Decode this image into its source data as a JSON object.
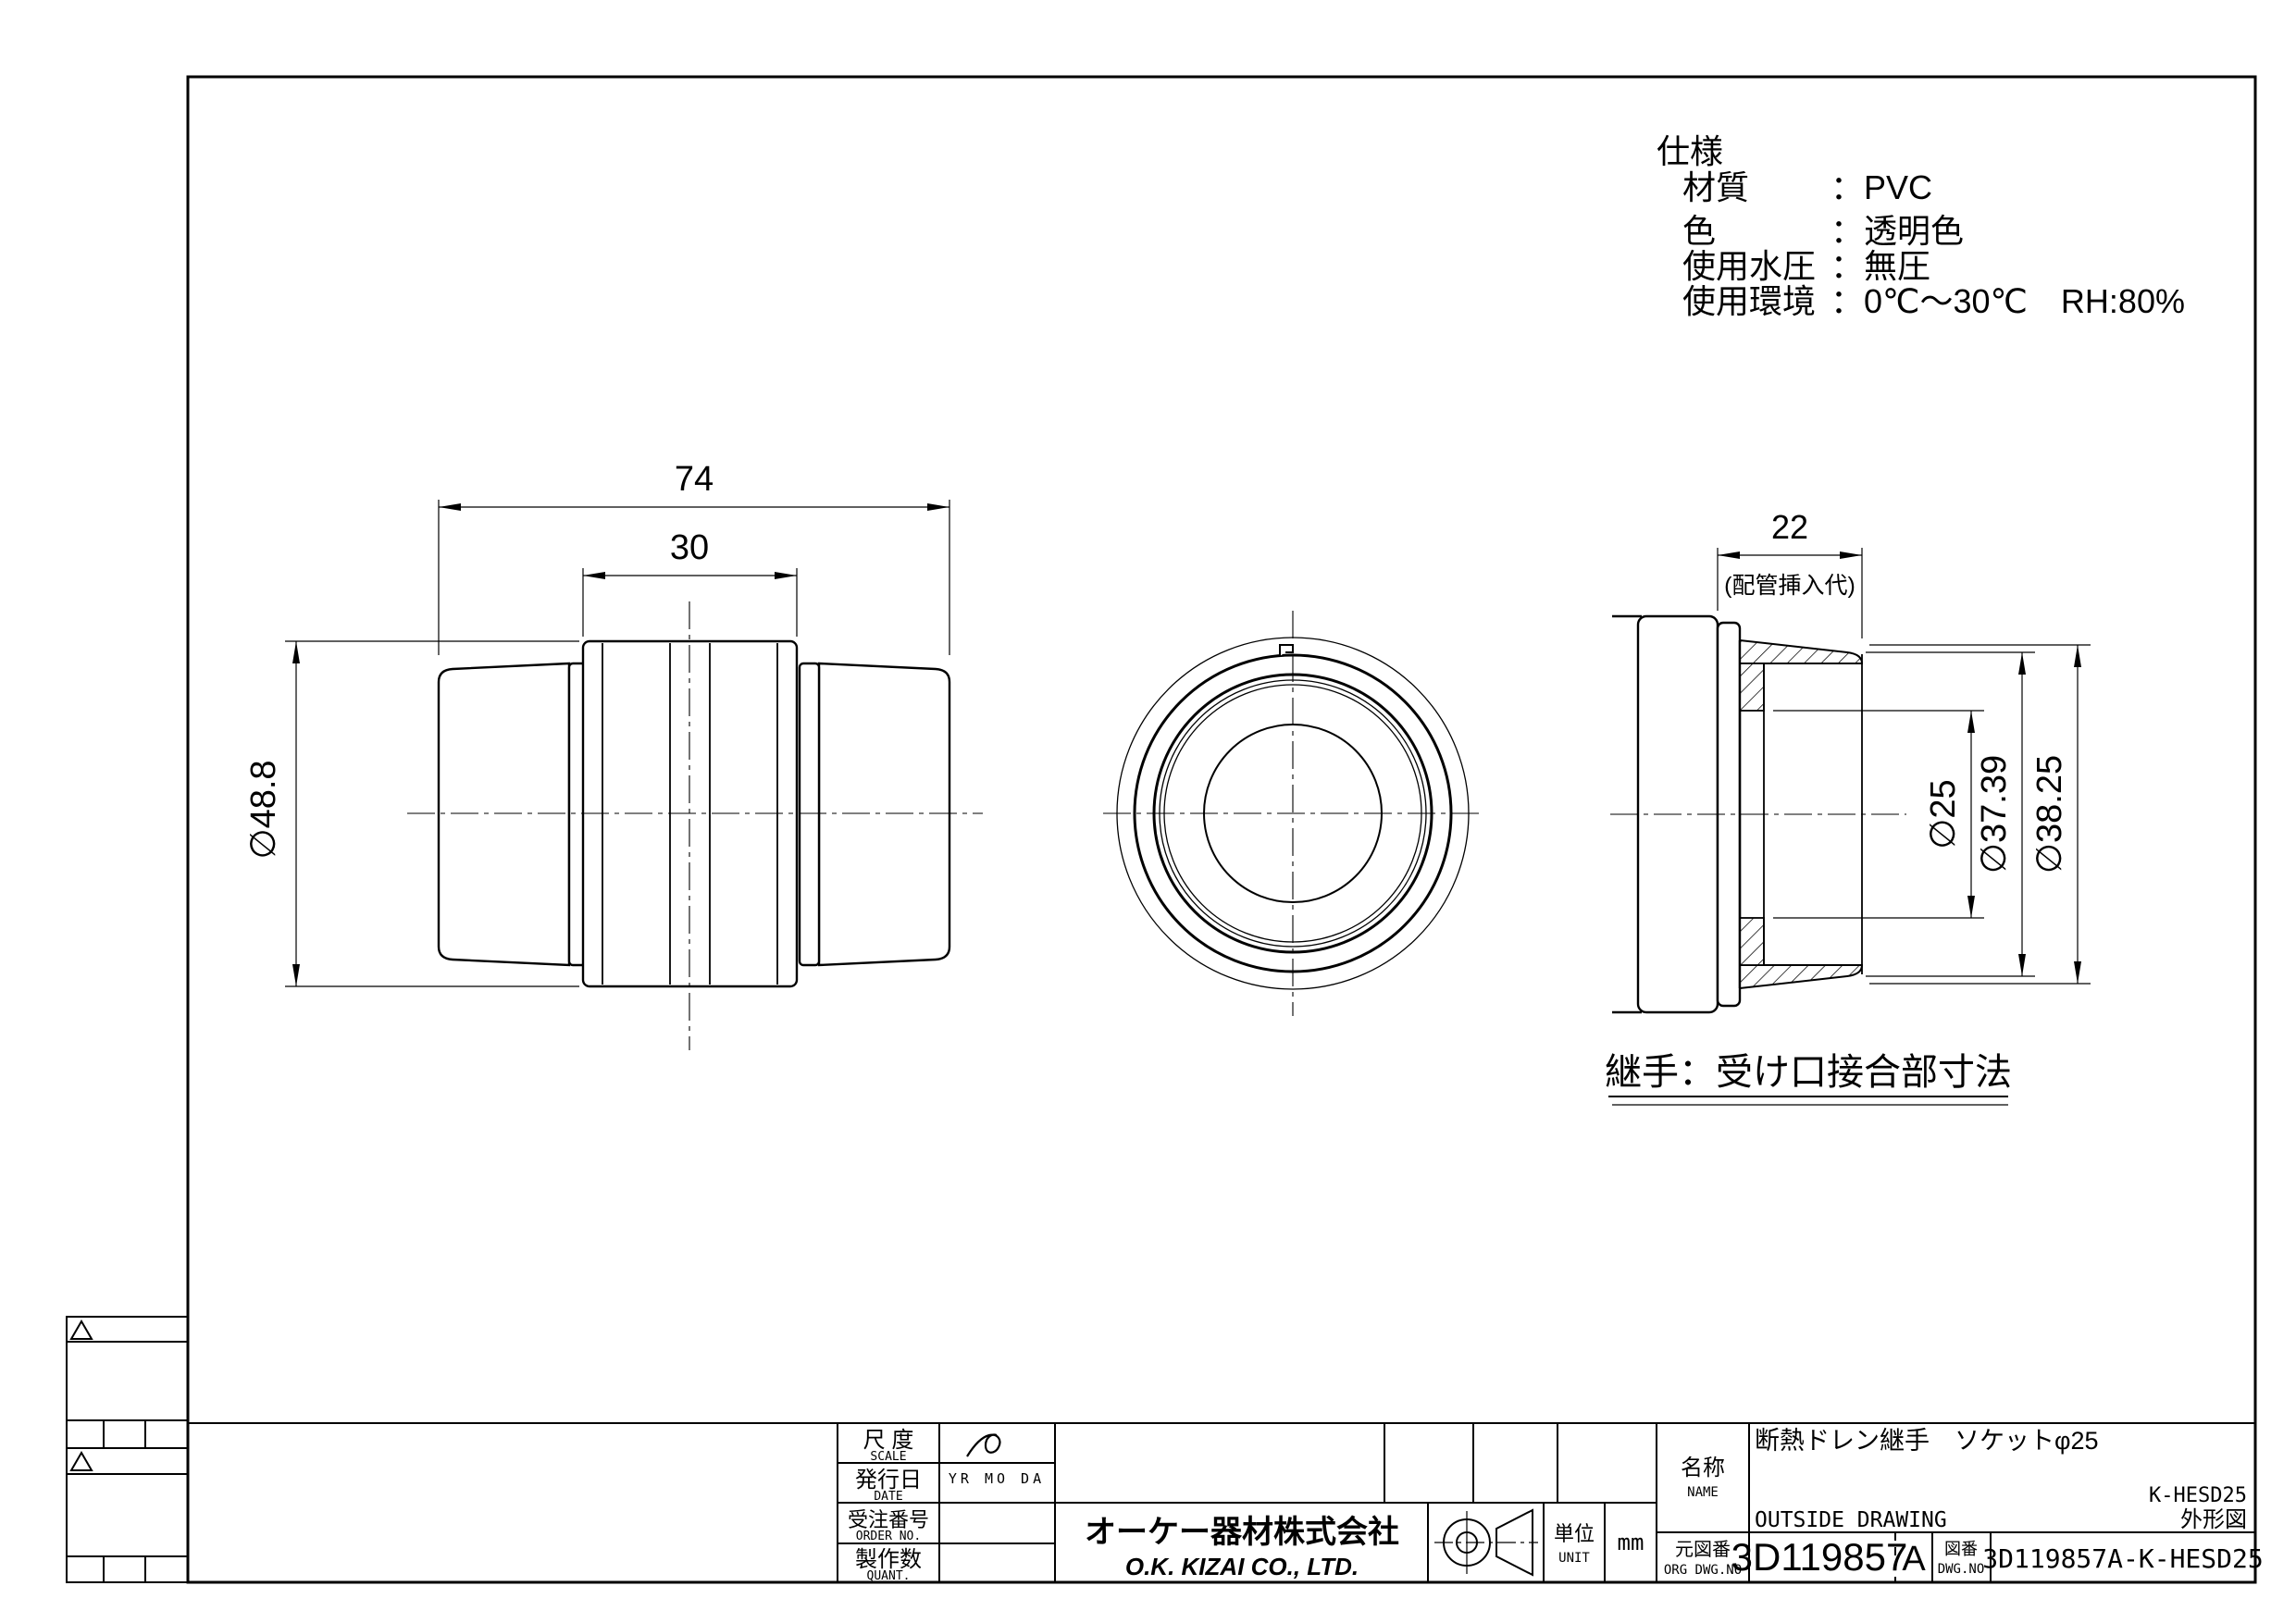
{
  "specs": {
    "title": "仕様",
    "colon": "：",
    "rows": [
      {
        "label": "材質",
        "value": "PVC"
      },
      {
        "label": "色",
        "value": "透明色"
      },
      {
        "label": "使用水圧",
        "value": "無圧"
      },
      {
        "label": "使用環境",
        "value": "0℃～30℃　RH:80%"
      }
    ]
  },
  "front_view": {
    "dim_overall": "74",
    "dim_body": "30",
    "dim_od": "∅48.8"
  },
  "section_view": {
    "dim_insert": "22",
    "dim_insert_note": "(配管挿入代)",
    "dim_bore": "∅25",
    "dim_socket": "∅37.39",
    "dim_od": "∅38.25",
    "caption": "継手：受け口接合部寸法"
  },
  "title_block": {
    "scale_label": "尺 度",
    "scale_label_en": "SCALE",
    "date_label": "発行日",
    "date_label_en": "DATE",
    "date_value": "YR MO DA",
    "order_label": "受注番号",
    "order_label_en": "ORDER NO.",
    "quantity_label": "製作数",
    "quantity_label_en": "QUANT.",
    "company_ja": "オーケー器材株式会社",
    "company_en": "O.K. KIZAI CO., LTD.",
    "unit_label": "単位",
    "unit_label_en": "UNIT",
    "unit_value": "mm",
    "name_label": "名称",
    "name_label_en": "NAME",
    "product_name": "断熱ドレン継手　ソケットφ25",
    "drawing_type": "OUTSIDE DRAWING",
    "model_code": "K-HESD25",
    "drawing_kind": "外形図",
    "org_dwg_label": "元図番",
    "org_dwg_label_en": "ORG DWG.NO",
    "org_dwg_value": "3D119857",
    "revision": "A",
    "dwg_label": "図番",
    "dwg_label_en": "DWG.NO",
    "dwg_value": "3D119857A-K-HESD25"
  }
}
